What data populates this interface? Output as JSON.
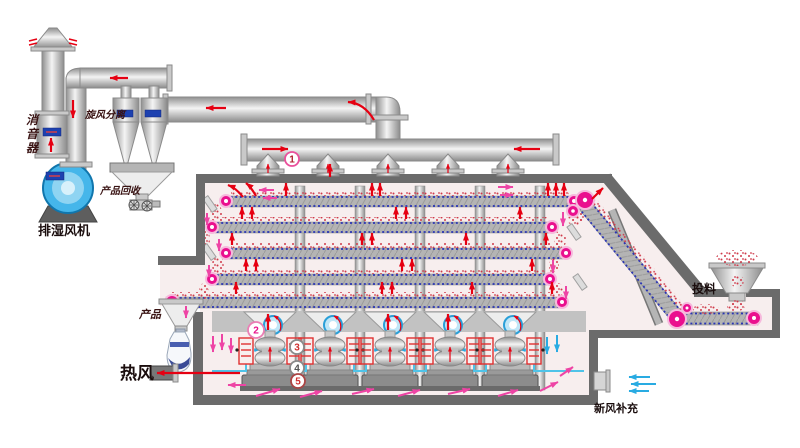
{
  "labels": {
    "muffler": [
      "消",
      "音",
      "器"
    ],
    "dehumid_fan": "排湿风机",
    "cyclone_separation": "旋风分离",
    "product_recovery": "产品回收",
    "product": "产品",
    "hot_air": "热风",
    "feeding": "投料",
    "fresh_air_makeup": "新风补充"
  },
  "markers": {
    "m1": "1",
    "m2": "2",
    "m3": "3",
    "m4": "4",
    "m5": "5"
  },
  "colors": {
    "hot_air_red": "#e60012",
    "circulation_pink": "#ee44a5",
    "fresh_air_blue": "#29abe2",
    "roller_magenta": "#ea0f8e",
    "material_red": "#cf3a4a",
    "belt_dot_blue": "#2a35b5",
    "fan_blue": "#45b6ea",
    "coil_red": "#e03030",
    "wall_gray": "#6b6b6b",
    "interior_pink": "#f7eeee",
    "label_dark": "#3a1414"
  }
}
